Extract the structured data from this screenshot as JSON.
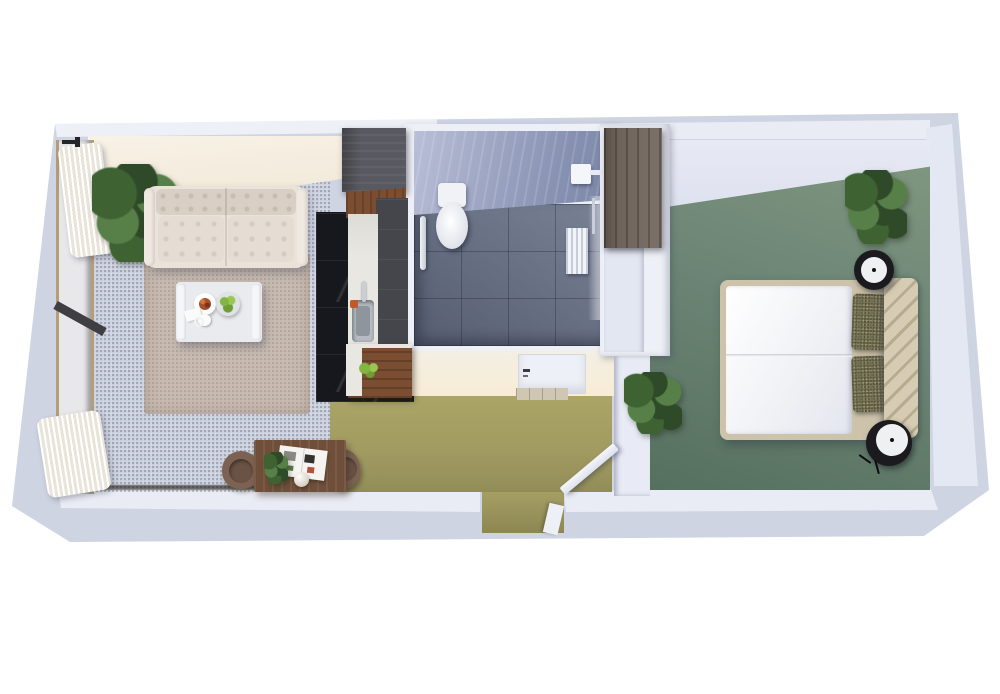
{
  "meta": {
    "description": "3D rendered top-down floor plan of a studio apartment",
    "view": "isometric top-down render",
    "background": "#ffffff"
  },
  "palette": {
    "page_bg": "#ffffff",
    "wall_base": "#cfd4e3",
    "wall_top_face": "#eef0f7",
    "wall_top_face2": "#e9ecf4",
    "wall_right_face": "#e4e8f2",
    "wall_white": "#eef0f7",
    "living_carpet": "#aaa56b",
    "living_carpet_dark": "#8f8a55",
    "corridor_carpet": "#a19b62",
    "bedroom_carpet": "#6c8576",
    "bedroom_carpet_dark": "#56705f",
    "rug": "#c7bbb2",
    "sofa": "#eae3da",
    "sofa_shade": "#d9cfc4",
    "table_white": "#e9ebef",
    "desk_wood": "#6f4f39",
    "chair_brown": "#7d6253",
    "cabinet_charcoal": "#595a61",
    "cabinet_charcoal_dark": "#45464c",
    "wood_walnut": "#7b4e31",
    "counter_white": "#e9e7e2",
    "marble_black": "#17181d",
    "tile_floor": "#6a7389",
    "tile_wall": "#99a1bf",
    "porcelain": "#f0f2f6",
    "chrome": "#c9ced8",
    "wardrobe_wood": "#6e635a",
    "bed_frame": "#cdc2aa",
    "duvet": "#f2f3f6",
    "headboard": "#d5ccb3",
    "headboard_groove": "#b7ac90",
    "pillow_olive": "#7a7754",
    "nightstand_black": "#1b1b1f",
    "nightstand_top": "#eff0f2",
    "plant_dark": "#2f4a28",
    "plant_mid": "#3f6233",
    "plant_light": "#578049",
    "door_white": "#eef0f7",
    "threshold": "#cfc6b4",
    "apple_green": "#84b441",
    "food_red": "#a4502a"
  },
  "rooms": [
    {
      "id": "living-room",
      "floor": "olive green carpet",
      "contents": [
        "tufted white sofa",
        "beige area rug",
        "white coffee table with plate, fruit bowl and cup",
        "corner plant",
        "window wall with white curtains",
        "wooden side table with two brown chairs, magazine, plant and sphere lamp"
      ]
    },
    {
      "id": "kitchenette",
      "floor": "black marble tile",
      "contents": [
        "charcoal tall cabinets",
        "white counter with sink and faucet",
        "walnut lower cabinet with green apples"
      ]
    },
    {
      "id": "bathroom",
      "floor": "slate blue tile",
      "contents": [
        "toilet",
        "chrome grab bar",
        "shower head",
        "white slatted grate",
        "white door with threshold"
      ]
    },
    {
      "id": "entry-hallway",
      "floor": "olive green carpet",
      "contents": [
        "entry opening in bottom wall",
        "open interior swing door",
        "partition wall",
        "plant"
      ]
    },
    {
      "id": "bedroom",
      "floor": "sage green carpet",
      "contents": [
        "double bed with white duvet",
        "two olive pillows",
        "channel-tufted beige headboard",
        "two round black nightstands",
        "dark wood wardrobe",
        "corner plant"
      ]
    }
  ]
}
